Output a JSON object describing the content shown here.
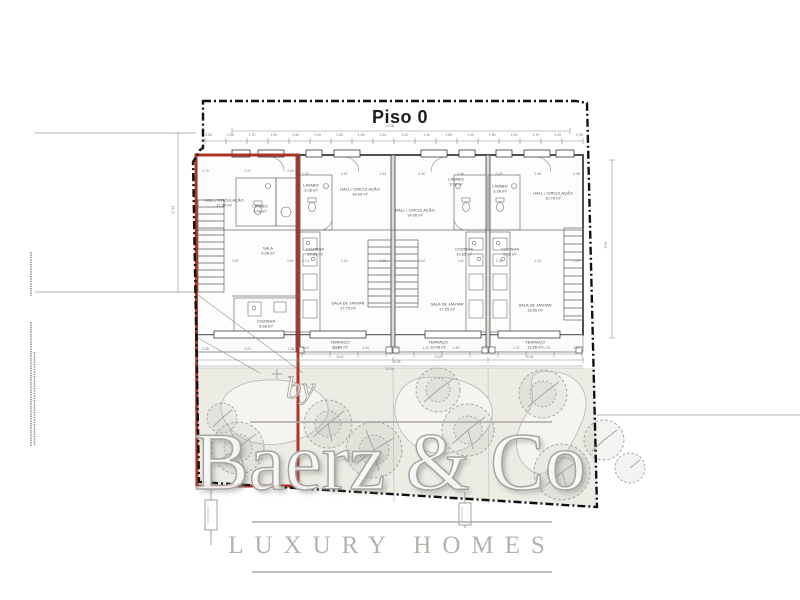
{
  "title": "Piso 0",
  "watermark": {
    "prefix": "by",
    "brand": "Baerz & Co",
    "tagline": "LUXURY HOMES"
  },
  "plan": {
    "total_width": "23.08",
    "overall_terrace": "22.16",
    "left_height": "11.34",
    "right_height": "9.55",
    "top_dims": [
      "0.38",
      "1.05",
      "1.70",
      "1.00",
      "1.50",
      "1.90",
      "1.00",
      "1.00",
      "1.52",
      "1.00",
      "1.00",
      "1.50",
      "1.00",
      "1.90",
      "1.00",
      "1.70",
      "1.00",
      "0.38"
    ],
    "unit1_top_dims": [
      "1.70",
      "0.37",
      "2.40"
    ],
    "upper_dims": [
      "1.02",
      "0.41",
      "2.44",
      "0.30",
      "2.46",
      "0.43",
      "2.46",
      "0.38"
    ],
    "unit1_mid_dims": [
      "2.87",
      "0.50"
    ],
    "mid_dims": [
      "2.13",
      "1.44",
      "1.00",
      "0.82",
      "1.62",
      "2.35",
      "1.03",
      "1.90"
    ],
    "unit1_bottom_dims": [
      "2.48",
      "0.97",
      "1.18"
    ],
    "terrace_dims": [
      "1.19",
      "1.49",
      "1.20",
      "1.52",
      "1.20",
      "1.49",
      "1.20",
      "1.47",
      "1.29",
      "1.20"
    ],
    "terrace_totals": {
      "t1": "5.45",
      "t2": "9.38",
      "t3": "5.32",
      "t4": "5.06"
    }
  },
  "units": [
    {
      "rooms": {
        "hall": {
          "name": "HALL / CIRCULAÇÃO",
          "area": "17.98 m²"
        },
        "lavabo": {
          "name": "LAVABO",
          "area": "2.43 m²"
        },
        "sala": {
          "name": "SALA",
          "area": "6.28 m²"
        },
        "cozinha": {
          "name": "COZINHA",
          "area": "8.68 m²"
        }
      }
    },
    {
      "rooms": {
        "lavabo": {
          "name": "LAVABO",
          "area": "3.36 m²"
        },
        "hall": {
          "name": "HALL / CIRCULAÇÃO",
          "area": "14.00 m²"
        },
        "cozinha": {
          "name": "COZINHA",
          "area": "10.65 m²"
        },
        "sala": {
          "name": "SALA DE JANTAR",
          "area": "17.75 m²"
        },
        "terraco": {
          "name": "TERRAÇO",
          "area": "10.90 m²"
        }
      }
    },
    {
      "rooms": {
        "lavabo": {
          "name": "LAVABO",
          "area": "3.38 m²"
        },
        "hall": {
          "name": "HALL / CIRCULAÇÃO",
          "area": "14.00 m²"
        },
        "cozinha": {
          "name": "COZINHA",
          "area": "10.65 m²"
        },
        "sala": {
          "name": "SALA DE JANTAR",
          "area": "17.25 m²"
        },
        "terraco": {
          "name": "TERRAÇO",
          "area": "10.45 m²"
        }
      }
    },
    {
      "rooms": {
        "lavabo": {
          "name": "LAVABO",
          "area": "3.38 m²"
        },
        "hall": {
          "name": "HALL / CIRCULAÇÃO",
          "area": "10.70 m²"
        },
        "cozinha": {
          "name": "COZINHA",
          "area": "9.55 m²"
        },
        "sala": {
          "name": "SALA DE JANTAR",
          "area": "18.65 m²"
        },
        "terraco": {
          "name": "TERRAÇO",
          "area": "11.85 m²"
        }
      }
    }
  ],
  "colors": {
    "red_outline": "#aa3527",
    "boundary": "#111111",
    "garden": "#ecebe4",
    "watermark_gray": "#a8a5a0"
  }
}
